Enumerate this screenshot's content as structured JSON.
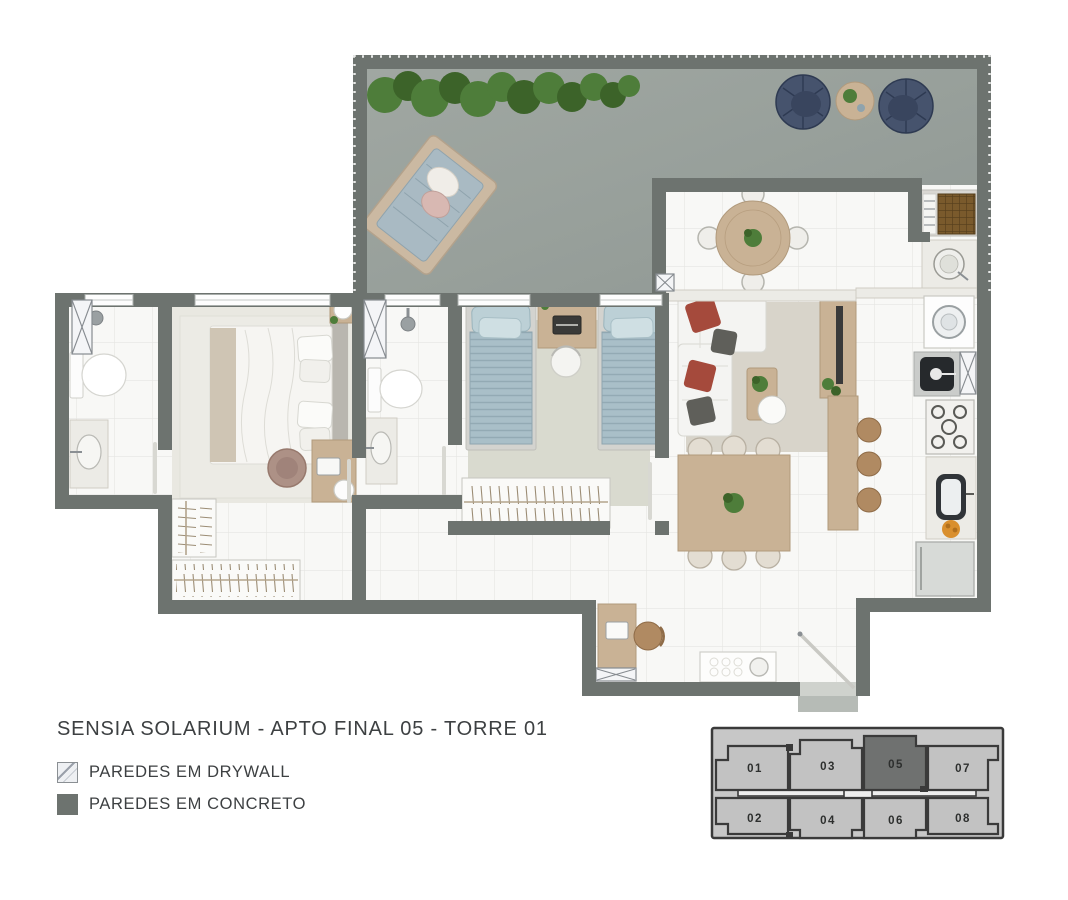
{
  "title": "SENSIA SOLARIUM - APTO FINAL 05 - TORRE 01",
  "legend": {
    "items": [
      {
        "label": "PAREDES EM DRYWALL",
        "swatch": "drywall-hatch"
      },
      {
        "label": "PAREDES EM CONCRETO",
        "swatch": "concrete-solid"
      }
    ]
  },
  "keyplan": {
    "units": [
      {
        "label": "01",
        "highlighted": false
      },
      {
        "label": "03",
        "highlighted": false
      },
      {
        "label": "05",
        "highlighted": true
      },
      {
        "label": "07",
        "highlighted": false
      },
      {
        "label": "02",
        "highlighted": false
      },
      {
        "label": "04",
        "highlighted": false
      },
      {
        "label": "06",
        "highlighted": false
      },
      {
        "label": "08",
        "highlighted": false
      }
    ]
  },
  "colors": {
    "wall_concrete": "#6d736f",
    "terrace_floor": "#9aa19c",
    "tile_floor": "#f8f8f6",
    "tile_line": "#e6e6e2",
    "carpet": "#e9e8e1",
    "bedroom2_carpet": "#d9dacf",
    "rug": "#d8d4ca",
    "wood": "#c9b295",
    "marble": "#ecebe6",
    "bed_blue": "#a9bfc8",
    "pillow_red": "#a54a3c",
    "pillow_gray": "#5f5f5a",
    "plant_green": "#4e7d3a",
    "plant_green_dark": "#3c6329",
    "chair_navy": "#46536d",
    "stool_brown": "#b08a62",
    "grill_brown": "#7a5a2c",
    "fruit_orange": "#d98f2e",
    "keyplan_base": "#c7c7c7",
    "keyplan_unit": "#c2c2c2",
    "keyplan_active": "#6f7170",
    "keyplan_core": "#ededed",
    "keyplan_line": "#3a3a3a",
    "text": "#3d4042"
  }
}
